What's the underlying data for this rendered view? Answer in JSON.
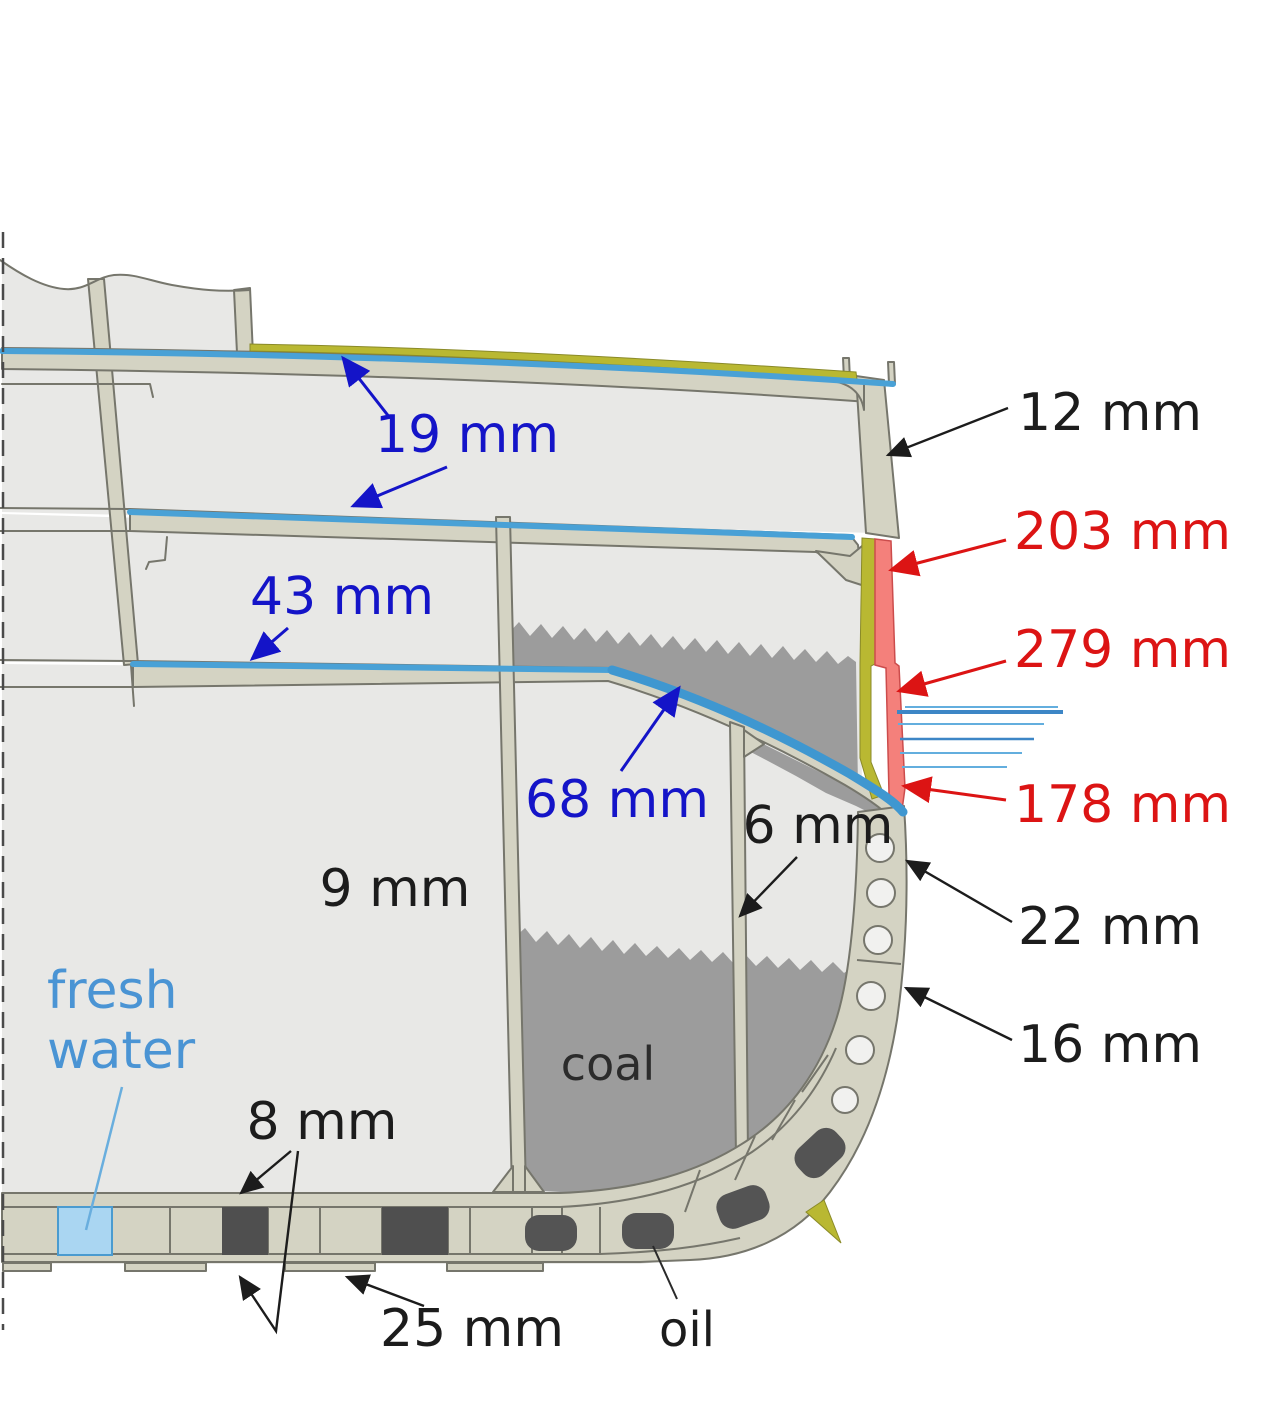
{
  "diagram": {
    "description": "ship hull cross-section with armor thicknesses",
    "units": "mm"
  },
  "colors": {
    "background": "#ffffff",
    "deck_label_blue": "#1414c8",
    "belt_label_red": "#dc1414",
    "plate_label_black": "#1c1c1c",
    "fresh_water_label": "#4a94d4",
    "coal_label": "#2b2b2b",
    "deck_line_blue": "#49a1d6",
    "slope_line_blue": "#3f97d0",
    "belt_armor_red": "#f4807b",
    "armor_backing_olive": "#b9b832",
    "structure_beige": "#d4d3c3",
    "structure_outline": "#76766c",
    "interior_gray": "#e8e8e6",
    "coal_gray": "#9c9c9c",
    "oil_dark": "#545454",
    "fresh_water_fill": "#aad6f2",
    "waterline_bold": "#3d86c6",
    "waterline_thin": "#63aede"
  },
  "labels": {
    "deck_upper": {
      "text": "19 mm"
    },
    "deck_middle": {
      "text": "43 mm"
    },
    "deck_slope": {
      "text": "68 mm"
    },
    "shell_upper": {
      "text": "12 mm"
    },
    "belt_upper": {
      "text": "203 mm"
    },
    "belt_middle": {
      "text": "279 mm"
    },
    "belt_lower": {
      "text": "178 mm"
    },
    "side_upper": {
      "text": "22 mm"
    },
    "side_lower": {
      "text": "16 mm"
    },
    "longitudinal_bulkhead": {
      "text": "9 mm"
    },
    "bunker_bulkhead": {
      "text": "6 mm"
    },
    "inner_bottom": {
      "text": "8 mm"
    },
    "outer_bottom": {
      "text": "25 mm"
    },
    "fresh_water_line1": "fresh",
    "fresh_water_line2": "water",
    "coal": "coal",
    "oil": "oil"
  },
  "waterline": {
    "lines": [
      {
        "y": 707,
        "x1": 905,
        "x2": 1058,
        "w": 2,
        "bold": false
      },
      {
        "y": 712,
        "x1": 897,
        "x2": 1063,
        "w": 4,
        "bold": true
      },
      {
        "y": 724,
        "x1": 898,
        "x2": 1044,
        "w": 2,
        "bold": false
      },
      {
        "y": 739,
        "x1": 900,
        "x2": 1034,
        "w": 2.6,
        "bold": true
      },
      {
        "y": 753,
        "x1": 900,
        "x2": 1022,
        "w": 2,
        "bold": false
      },
      {
        "y": 767,
        "x1": 902,
        "x2": 1007,
        "w": 2,
        "bold": false
      }
    ]
  }
}
